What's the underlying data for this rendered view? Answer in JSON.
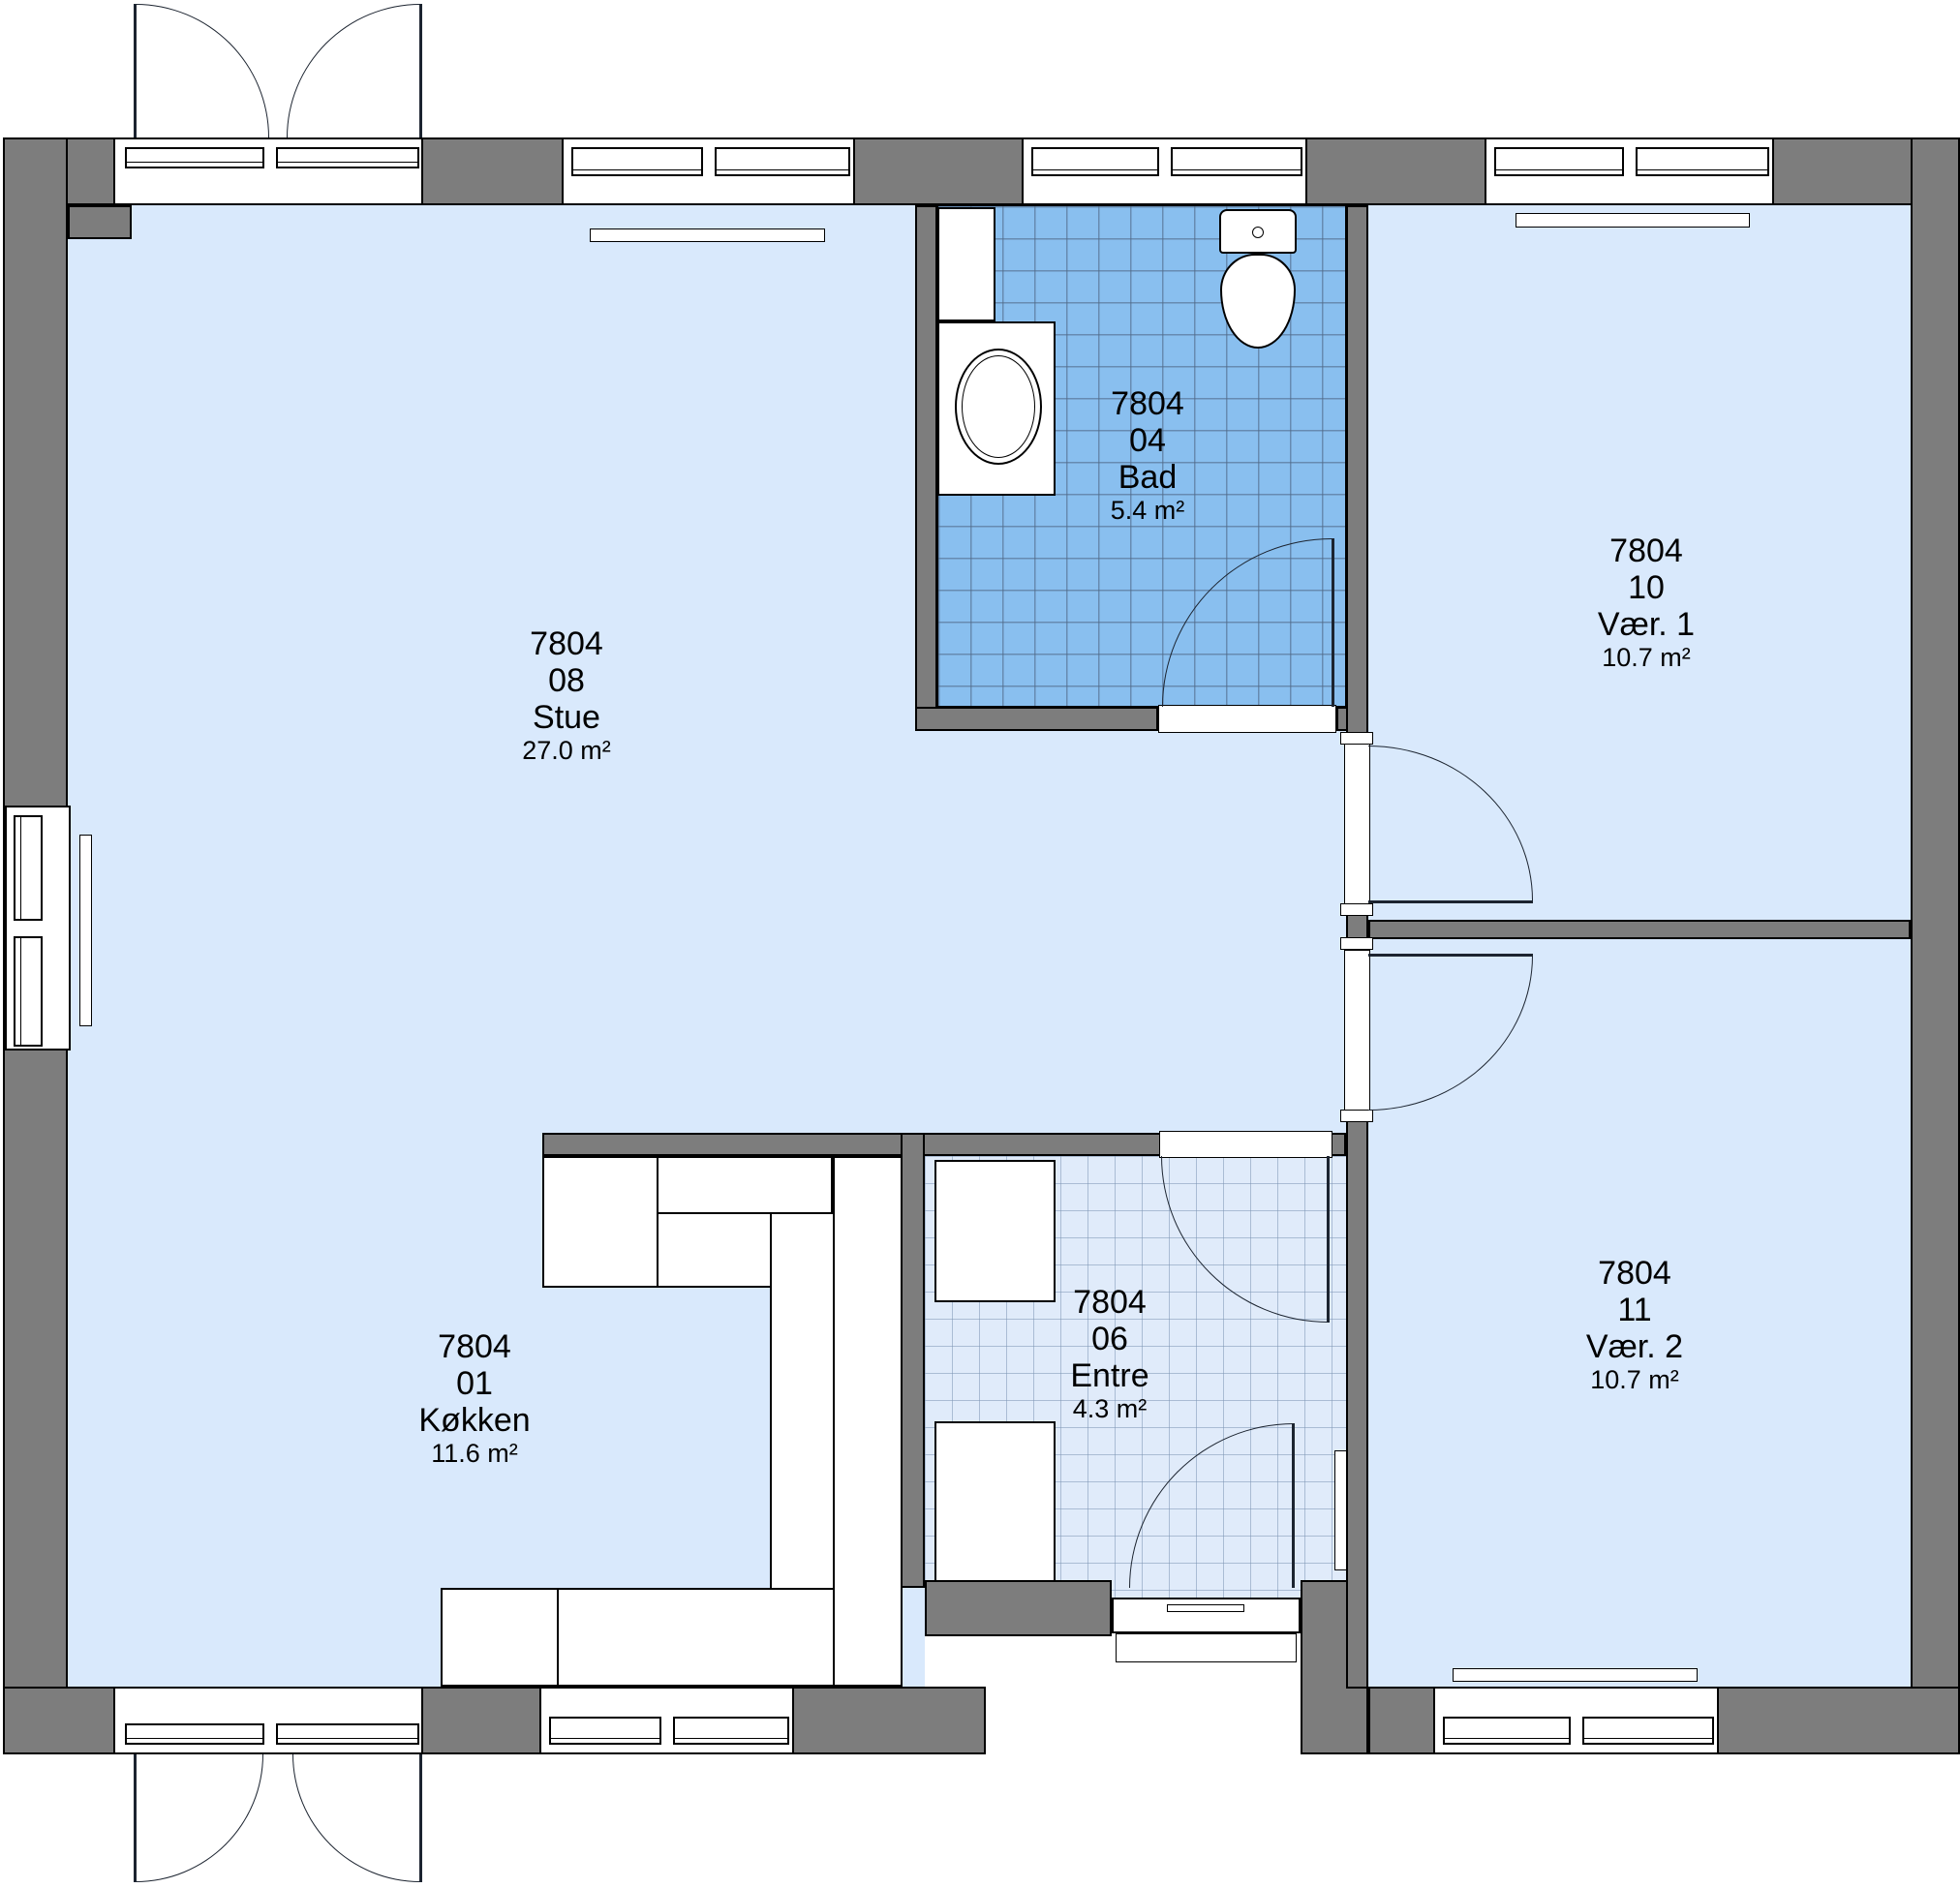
{
  "plan": {
    "type": "floor-plan",
    "colors": {
      "wall": "#7d7d7d",
      "floor": "#d9e9fc",
      "bathroom_tile": "#89bfef",
      "entry_tile": "#e0ebfa",
      "outline": "#000000"
    }
  },
  "rooms": [
    {
      "code": "7804",
      "number": "08",
      "name": "Stue",
      "area": "27.0 m²"
    },
    {
      "code": "7804",
      "number": "01",
      "name": "Køkken",
      "area": "11.6 m²"
    },
    {
      "code": "7804",
      "number": "04",
      "name": "Bad",
      "area": "5.4 m²"
    },
    {
      "code": "7804",
      "number": "06",
      "name": "Entre",
      "area": "4.3 m²"
    },
    {
      "code": "7804",
      "number": "10",
      "name": "Vær. 1",
      "area": "10.7 m²"
    },
    {
      "code": "7804",
      "number": "11",
      "name": "Vær. 2",
      "area": "10.7 m²"
    }
  ]
}
